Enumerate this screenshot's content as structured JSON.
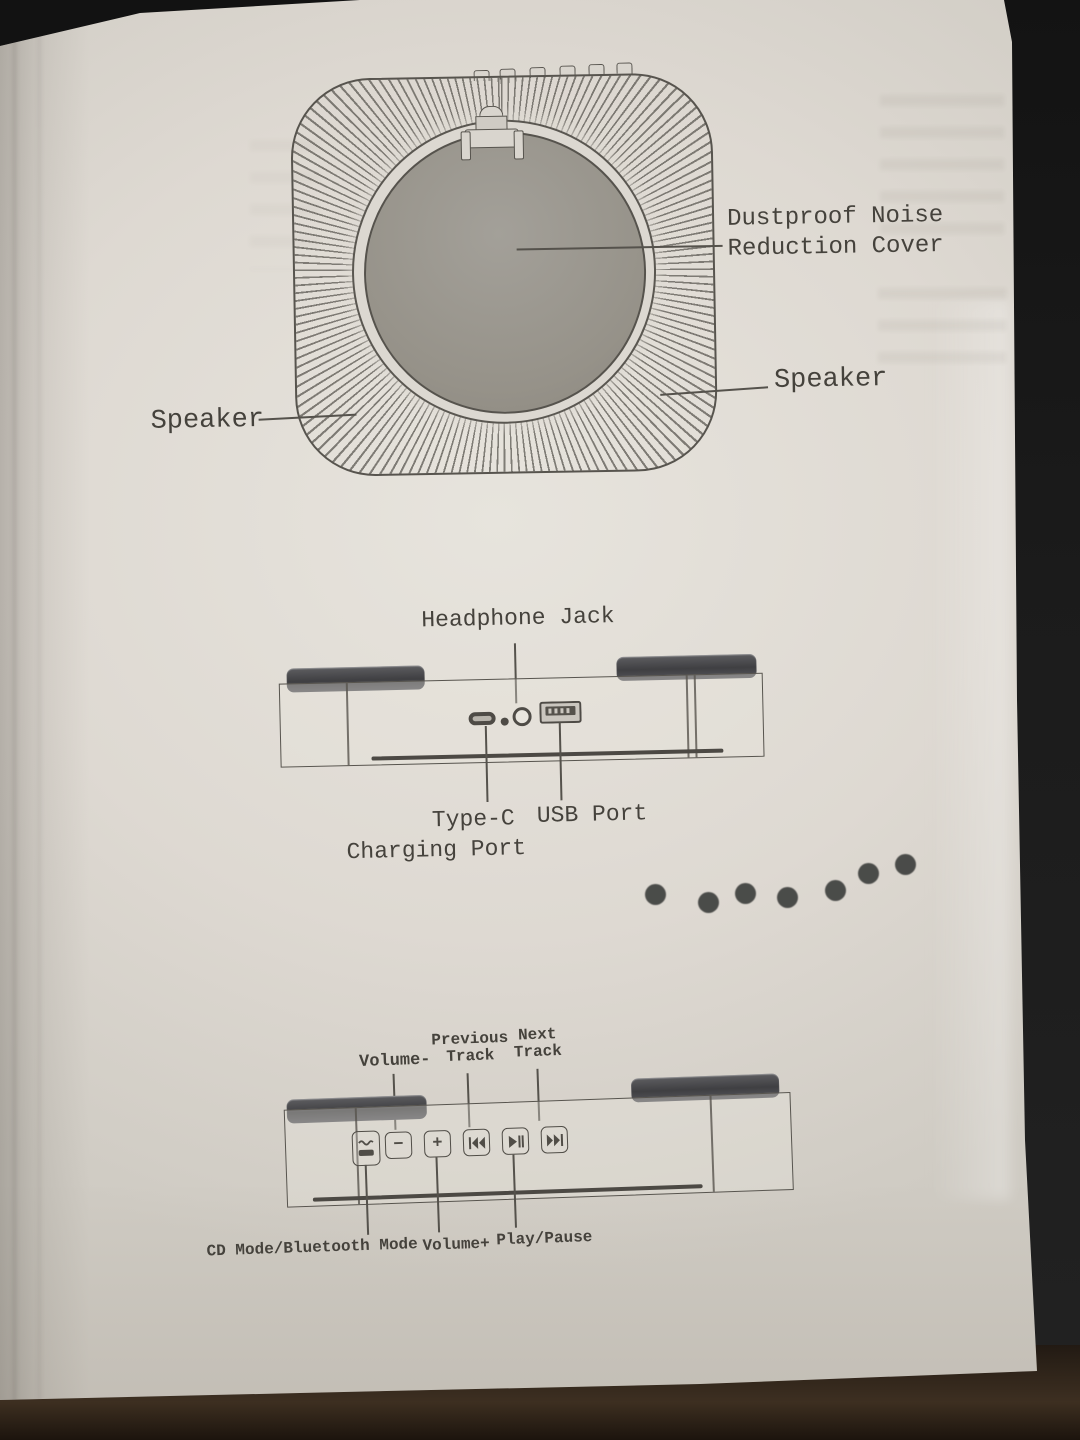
{
  "colors": {
    "paper": "#ded9d2",
    "ink": "#45423c",
    "line_art": "#57544e",
    "cover_gray": "#969289",
    "foot_dark": "#4a4a4d",
    "table_black": "#121212",
    "table_brown": "#3d2f21",
    "bleed_dot": "#3b3d3b"
  },
  "top_diagram": {
    "labels": {
      "cover_line1": "Dustproof Noise",
      "cover_line2": "Reduction Cover",
      "speaker_left": "Speaker",
      "speaker_right": "Speaker"
    },
    "parts": [
      "dustproof-noise-reduction-cover",
      "speaker-left",
      "speaker-right",
      "lid-latch"
    ]
  },
  "middle_diagram": {
    "labels": {
      "headphone_jack": "Headphone Jack",
      "type_c_line1": "Type-C",
      "type_c_line2": "Charging Port",
      "usb_port": "USB Port"
    },
    "parts": [
      "type-c-charging-port",
      "headphone-jack",
      "usb-port"
    ]
  },
  "bottom_diagram": {
    "labels": {
      "volume_minus": "Volume-",
      "previous_line1": "Previous",
      "previous_line2": "Track",
      "next_line1": "Next",
      "next_line2": "Track",
      "cd_bt_mode": "CD Mode/Bluetooth Mode",
      "volume_plus": "Volume+",
      "play_pause": "Play/Pause"
    },
    "buttons": {
      "minus_glyph": "−",
      "plus_glyph": "+"
    }
  }
}
